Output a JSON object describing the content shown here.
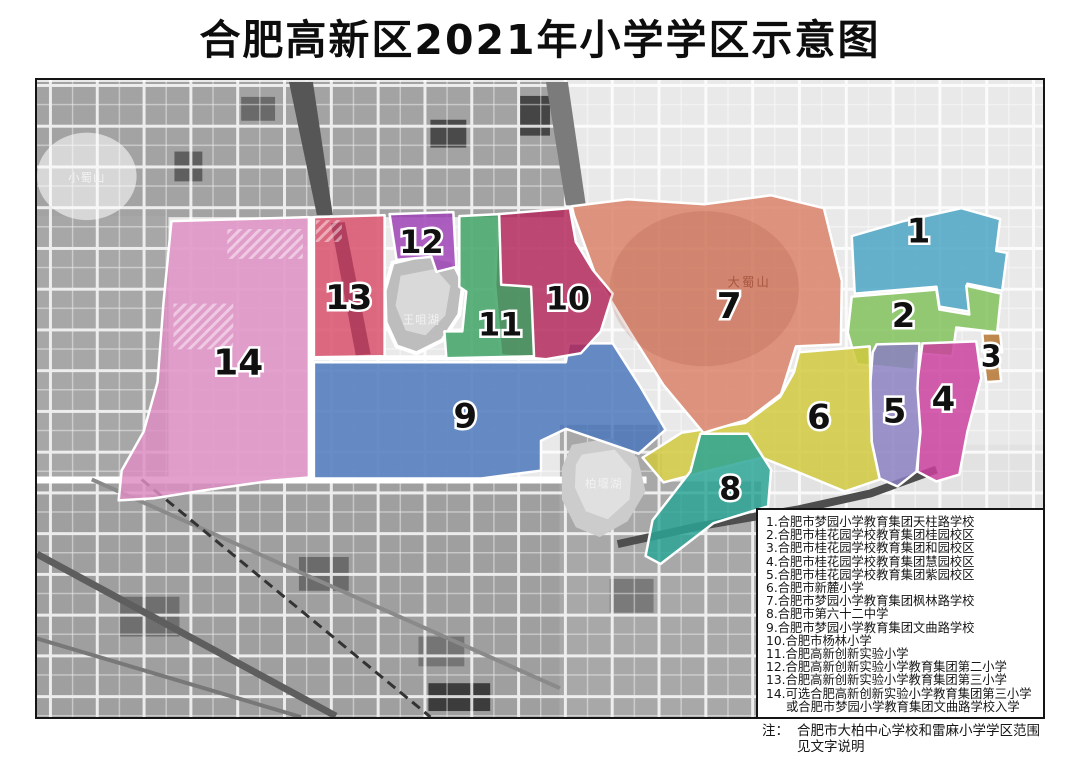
{
  "title": "合肥高新区2021年小学学区示意图",
  "map": {
    "labels": {
      "xiaoshushan": "小蜀山",
      "dashushan": "大蜀山",
      "wangzuihu": "王咀湖",
      "baiyanhu": "柏堰湖"
    },
    "regions": [
      {
        "num": "1",
        "color": "#4aa3c2",
        "size": 34,
        "lx": 920,
        "ly": 230,
        "points": "853,235 905,220 963,207 1002,218 998,250 1009,252 1004,290 969,283 971,311 941,306 938,286 856,293"
      },
      {
        "num": "2",
        "color": "#7fc159",
        "size": 34,
        "lx": 905,
        "ly": 315,
        "points": "853,296 938,289 941,309 971,314 968,285 1003,293 999,332 958,327 954,356 918,353 916,370 858,364 849,332"
      },
      {
        "num": "3",
        "color": "#b4742f",
        "size": 30,
        "lx": 993,
        "ly": 357,
        "points": "984,333 1002,333 1004,352 986,353"
      },
      {
        "num": "",
        "color": "#b4742f",
        "size": 0,
        "lx": 0,
        "ly": 0,
        "points": "986,364 1001,363 1003,381 988,382"
      },
      {
        "num": "4",
        "color": "#ca3f9d",
        "size": 34,
        "lx": 945,
        "ly": 399,
        "points": "924,343 978,341 983,378 969,432 961,475 938,482 919,472 921,432 918,388"
      },
      {
        "num": "5",
        "color": "#8c80c2",
        "size": 34,
        "lx": 896,
        "ly": 411,
        "points": "878,344 921,343 919,389 922,432 918,472 899,487 881,479 873,442 871,392 874,352"
      },
      {
        "num": "6",
        "color": "#d0c93e",
        "size": 34,
        "lx": 820,
        "ly": 417,
        "points": "800,352 871,346 873,442 881,480 846,492 800,473 763,458 706,472 664,483 643,458 682,433 746,423 781,397 795,372"
      },
      {
        "num": "7",
        "color": "#d98166",
        "size": 36,
        "lx": 730,
        "ly": 306,
        "points": "572,205 628,198 705,203 772,194 825,207 843,280 842,344 797,346 782,394 748,420 704,433 664,385 630,331 596,275 574,214"
      },
      {
        "num": "8",
        "color": "#2aa595",
        "size": 32,
        "lx": 731,
        "ly": 489,
        "points": "701,434 749,434 772,470 769,507 714,524 661,565 646,557 653,521 691,472"
      },
      {
        "num": "9",
        "color": "#4a76bb",
        "size": 34,
        "lx": 465,
        "ly": 416,
        "points": "313,362 566,362 569,343 613,343 641,387 666,430 639,454 601,441 566,429 541,441 541,471 481,479 313,479"
      },
      {
        "num": "10",
        "color": "#b3275b",
        "size": 32,
        "lx": 568,
        "ly": 298,
        "points": "498,213 570,207 576,241 593,269 613,293 601,331 581,353 546,359 501,355 495,284"
      },
      {
        "num": "11",
        "color": "#3da263",
        "size": 32,
        "lx": 500,
        "ly": 324,
        "points": "459,215 499,213 501,284 531,286 534,356 446,358 444,331 462,331 466,291 459,286"
      },
      {
        "num": "12",
        "color": "#9d41b5",
        "size": 32,
        "lx": 421,
        "ly": 241,
        "points": "389,213 453,211 456,266 436,271 431,256 396,259"
      },
      {
        "num": "13",
        "color": "#d94f6b",
        "size": 34,
        "lx": 348,
        "ly": 297,
        "points": "313,216 384,214 384,356 313,357"
      },
      {
        "num": "14",
        "color": "#de8ec4",
        "size": 36,
        "lx": 237,
        "ly": 363,
        "points": "170,220 308,216 308,478 272,481 202,491 152,499 117,501 120,471 142,432 156,382 162,302"
      }
    ]
  },
  "legend": {
    "items": [
      "1.合肥市梦园小学教育集团天柱路学校",
      "2.合肥市桂花园学校教育集团桂园校区",
      "3.合肥市桂花园学校教育集团和园校区",
      "4.合肥市桂花园学校教育集团慧园校区",
      "5.合肥市桂花园学校教育集团紫园校区",
      "6.合肥市新麓小学",
      "7.合肥市梦园小学教育集团枫林路学校",
      "8.合肥市第六十二中学",
      "9.合肥市梦园小学教育集团文曲路学校",
      "10.合肥市杨林小学",
      "11.合肥高新创新实验小学",
      "12.合肥高新创新实验小学教育集团第二小学",
      "13.合肥高新创新实验小学教育集团第三小学",
      "14.可选合肥高新创新实验小学教育集团第三小学",
      "或合肥市梦园小学教育集团文曲路学校入学"
    ]
  },
  "note": {
    "prefix": "注：",
    "line1": "合肥市大柏中心学校和雷麻小学学区范围",
    "line2": "见文字说明"
  }
}
